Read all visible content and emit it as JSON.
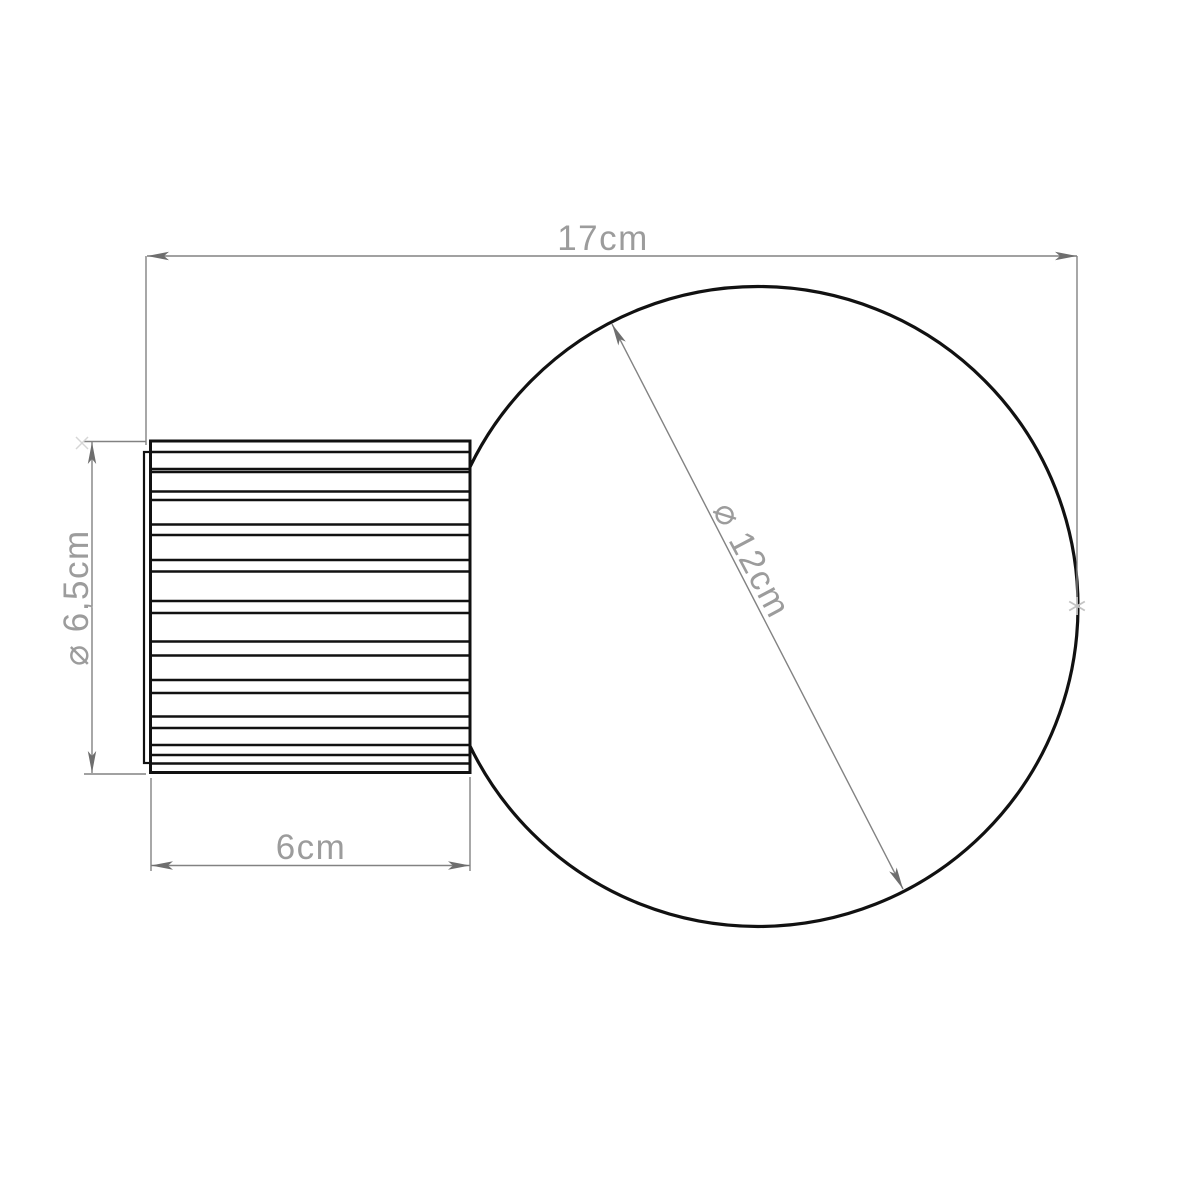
{
  "dimensions": {
    "total_width": {
      "label": "17cm"
    },
    "globe_diameter": {
      "label": "⌀ 12cm"
    },
    "base_diameter": {
      "label": "⌀ 6,5cm"
    },
    "base_depth": {
      "label": "6cm"
    }
  },
  "colors": {
    "outline": "#111111",
    "dimension_line": "#828282",
    "arrow": "#6e6e6e",
    "dimension_text": "#9c9c9c",
    "marker": "#c3c3c3",
    "background": "#ffffff"
  }
}
